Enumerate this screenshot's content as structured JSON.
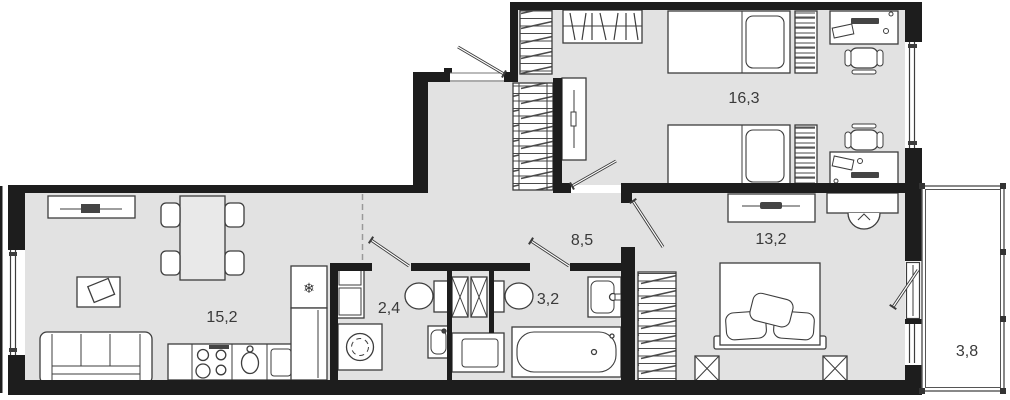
{
  "plan": {
    "type": "apartment-floor-plan",
    "rooms": [
      {
        "id": "living-kitchen",
        "label": "15,2",
        "furniture": [
          "sofa",
          "coffee-table",
          "tv-stand",
          "dining-table",
          "four-chairs",
          "stove",
          "kitchen-sink",
          "dishwasher",
          "fridge",
          "counter"
        ]
      },
      {
        "id": "hallway",
        "label": "8,5",
        "furniture": [
          "hall-wardrobe"
        ]
      },
      {
        "id": "wc-laundry",
        "label": "2,4",
        "furniture": [
          "shelving",
          "washing-machine",
          "toilet",
          "small-sink"
        ]
      },
      {
        "id": "bathroom",
        "label": "3,2",
        "furniture": [
          "toilet",
          "washbasin",
          "bathtub",
          "cabinet",
          "vent-shafts"
        ]
      },
      {
        "id": "bedroom-children",
        "label": "16,3",
        "furniture": [
          "wardrobe",
          "hanger-rack",
          "bed-1",
          "bed-2",
          "shelf-1",
          "shelf-2",
          "desk-1",
          "desk-2",
          "chair-1",
          "chair-2",
          "cabinet"
        ]
      },
      {
        "id": "bedroom-master",
        "label": "13,2",
        "furniture": [
          "dresser",
          "desk",
          "desk-chair",
          "wardrobe",
          "double-bed",
          "nightstand-1",
          "nightstand-2"
        ]
      },
      {
        "id": "balcony",
        "label": "3,8",
        "furniture": []
      }
    ],
    "icons": {
      "fridge": "❄"
    },
    "colors": {
      "floor": "#e2e2e2",
      "wall": "#1d1d1d",
      "furniture_line": "#3d3d3d",
      "balcony_floor": "#ffffff",
      "dashed_divider": "#999999"
    }
  }
}
